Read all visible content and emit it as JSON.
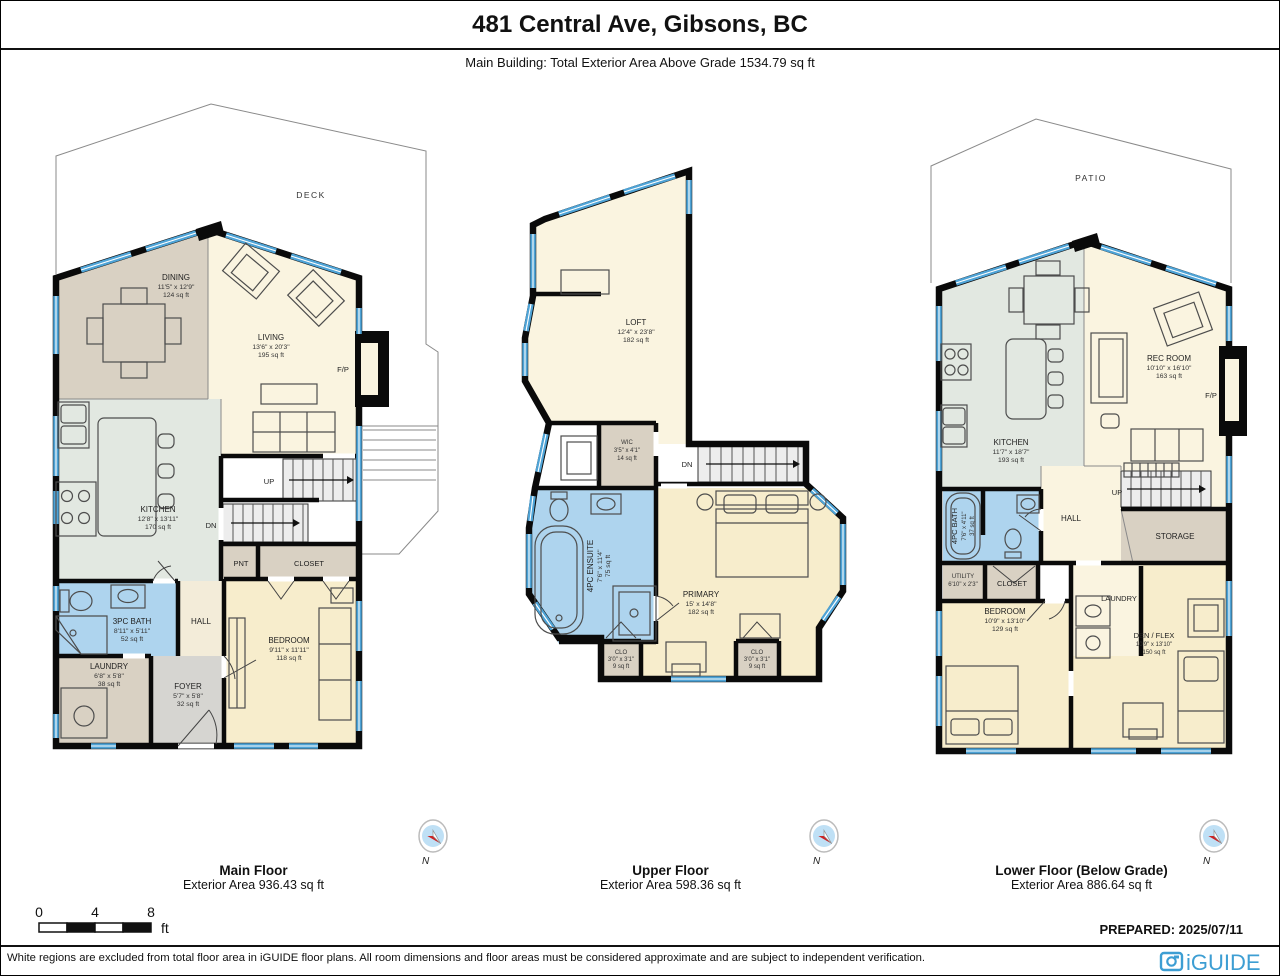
{
  "header": {
    "title": "481 Central Ave, Gibsons, BC",
    "subtitle": "Main Building: Total Exterior Area Above Grade 1534.79 sq ft"
  },
  "palette": {
    "wall": "#0a0a0a",
    "window_blue": "#4ea3d6",
    "bath_blue": "#aed4ee",
    "cream": "#faf4e0",
    "yellow": "#f7edcc",
    "tan": "#d9d1c3",
    "green": "#e2e8e1",
    "gray": "#d6d5d1",
    "stair": "#ededed",
    "brand_blue": "#3d9ed3"
  },
  "compass": {
    "n": "N"
  },
  "floors": {
    "main": {
      "label": "Main Floor",
      "area_label": "Exterior Area 936.43 sq ft",
      "outdoor": "DECK",
      "up": "UP",
      "dn": "DN",
      "rooms": {
        "dining": {
          "name": "DINING",
          "dims": "11'5\" x 12'9\"",
          "area": "124 sq ft"
        },
        "living": {
          "name": "LIVING",
          "dims": "13'6\" x 20'3\"",
          "area": "195 sq ft"
        },
        "kitchen": {
          "name": "KITCHEN",
          "dims": "12'8\" x 13'11\"",
          "area": "170 sq ft"
        },
        "bath": {
          "name": "3PC BATH",
          "dims": "8'11\" x 5'11\"",
          "area": "52 sq ft"
        },
        "hall": {
          "name": "HALL"
        },
        "laundry": {
          "name": "LAUNDRY",
          "dims": "6'8\" x 5'8\"",
          "area": "38 sq ft"
        },
        "foyer": {
          "name": "FOYER",
          "dims": "5'7\" x 5'8\"",
          "area": "32 sq ft"
        },
        "bedroom": {
          "name": "BEDROOM",
          "dims": "9'11\" x 11'11\"",
          "area": "118 sq ft"
        },
        "pnt": {
          "name": "PNT"
        },
        "closet": {
          "name": "CLOSET"
        },
        "fireplace": {
          "name": "F/P"
        }
      }
    },
    "upper": {
      "label": "Upper Floor",
      "area_label": "Exterior Area 598.36 sq ft",
      "dn": "DN",
      "rooms": {
        "loft": {
          "name": "LOFT",
          "dims": "12'4\" x 23'8\"",
          "area": "182 sq ft"
        },
        "wic": {
          "name": "WIC",
          "dims": "3'5\" x 4'1\"",
          "area": "14 sq ft"
        },
        "ensuite": {
          "name": "4PC ENSUITE",
          "dims": "7'6\" x 11'4\"",
          "area": "75 sq ft"
        },
        "primary": {
          "name": "PRIMARY",
          "dims": "15' x 14'8\"",
          "area": "182 sq ft"
        },
        "closet_left": {
          "name": "CLO",
          "dims": "3'0\" x 3'1\"",
          "area": "9 sq ft"
        },
        "closet_right": {
          "name": "CLO",
          "dims": "3'0\" x 3'1\"",
          "area": "9 sq ft"
        }
      }
    },
    "lower": {
      "label": "Lower Floor (Below Grade)",
      "area_label": "Exterior Area 886.64 sq ft",
      "outdoor": "PATIO",
      "up": "UP",
      "rooms": {
        "kitchen": {
          "name": "KITCHEN",
          "dims": "11'7\" x 18'7\"",
          "area": "193 sq ft"
        },
        "rec": {
          "name": "REC ROOM",
          "dims": "10'10\" x 16'10\"",
          "area": "163 sq ft"
        },
        "bath": {
          "name": "4PC BATH",
          "dims": "7'6\" x 4'11\"",
          "area": "37 sq ft"
        },
        "hall": {
          "name": "HALL"
        },
        "storage": {
          "name": "STORAGE"
        },
        "utility": {
          "name": "UTILITY",
          "dims": "6'10\" x 2'3\""
        },
        "closet": {
          "name": "CLOSET"
        },
        "bedroom": {
          "name": "BEDROOM",
          "dims": "10'9\" x 13'10\"",
          "area": "129 sq ft"
        },
        "laundry": {
          "name": "LAUNDRY"
        },
        "den": {
          "name": "DEN / FLEX",
          "dims": "10'9\" x 13'10\"",
          "area": "150 sq ft"
        },
        "fireplace": {
          "name": "F/P"
        }
      }
    }
  },
  "scale_bar": {
    "ticks": [
      "0",
      "4",
      "8"
    ],
    "unit": "ft"
  },
  "footer": {
    "prepared": "PREPARED: 2025/07/11",
    "disclaimer": "White regions are excluded from total floor area in iGUIDE floor plans. All room dimensions and floor areas must be considered approximate and are subject to independent verification.",
    "brand": "iGUIDE"
  }
}
